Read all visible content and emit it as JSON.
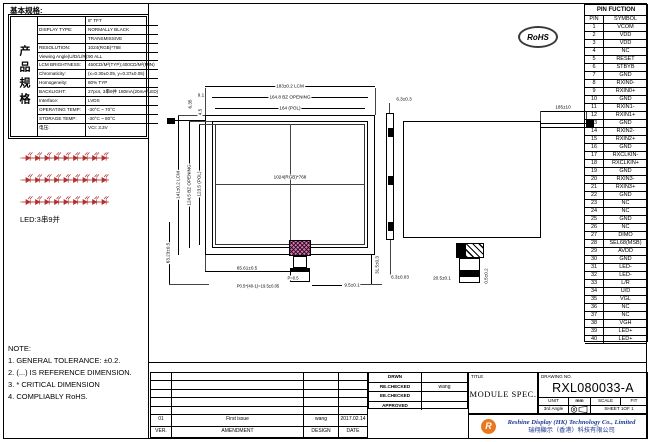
{
  "spec": {
    "header": "基本规格:",
    "side_label": "产品规格",
    "rows": [
      {
        "label": "",
        "value": "8\" TFT"
      },
      {
        "label": "DISPLAY TYPE:",
        "value": "NORMALLY BLACK"
      },
      {
        "label": "",
        "value": "TRANSMISSIVE"
      },
      {
        "label": "RESOLUTION:",
        "value": "1024(RGB)*768"
      },
      {
        "label": "Viewing Angle(U/D/L/R):",
        "value": "90  ALL"
      },
      {
        "label": "LCM BRIGHTNESS:",
        "value": "450CD/M²(TYP);400CD/M²(MIN)"
      },
      {
        "label": "Chromaticity:",
        "value": "(x=0.30±0.05, y=0.37±0.05)"
      },
      {
        "label": "Homogeneity:",
        "value": "80% TYP"
      },
      {
        "label": "BACKLIGHT:",
        "value": "27pcs, 3串9并 180mA(20mA/LED)"
      },
      {
        "label": "Interface:",
        "value": "LVDS"
      },
      {
        "label": "OPERATING TEMP:",
        "value": "-30°C ~ 70°C"
      },
      {
        "label": "STORAGE TEMP:",
        "value": "-30°C ~ 80°C"
      },
      {
        "label": "电压:",
        "value": "VCI: 3.3V"
      }
    ]
  },
  "led": {
    "label": "LED:3串9并"
  },
  "notes": {
    "title": "NOTE:",
    "items": [
      "1. GENERAL TOLERANCE: ±0.2.",
      "2. (...) IS REFERENCE DIMENSION.",
      "3. * CRITICAL DIMENSION",
      "4. COMPLIABLY RoHS."
    ]
  },
  "rohs": "RoHS",
  "front_view": {
    "dims": {
      "width_lcm": "183±0.2 LCM",
      "width_bz": "164.8  BZ OPENING",
      "width_pol": "164  (POL)",
      "offset_top": "9.1",
      "height_lcm": "141±0.2 LCM",
      "height_bz": "124.5 BZ OPENING",
      "height_pol": "123.5 (POL)",
      "offset_left_a": "6.35",
      "offset_left_b": "4.5",
      "resolution": "1024(RGB)*768",
      "fpc_x": "65.61±0.5",
      "fpc_y": "63.23±0.5",
      "fpc_drop": "31.5±0.3",
      "pitch": "P=0.5",
      "pitch_total": "P0.5*(40-1)=19.5±0.05",
      "end_margin": "9.5±0.1"
    }
  },
  "rear_view": {
    "dims": {
      "thickness_top": "6.3±0.3",
      "thickness_bottom": "6.3±0.03",
      "wire_length": "185±10",
      "fpc_width": "20.5±0.1",
      "fpc_side": "0.5±0.2"
    }
  },
  "pins": {
    "title": "PIN FUCTION",
    "col_pin": "PIN",
    "col_symbol": "SYMBOL",
    "rows": [
      {
        "pin": "1",
        "symbol": "VCOM"
      },
      {
        "pin": "2",
        "symbol": "VDD"
      },
      {
        "pin": "3",
        "symbol": "VDD"
      },
      {
        "pin": "4",
        "symbol": "NC"
      },
      {
        "pin": "5",
        "symbol": "RESET"
      },
      {
        "pin": "6",
        "symbol": "STBYB"
      },
      {
        "pin": "7",
        "symbol": "GND"
      },
      {
        "pin": "8",
        "symbol": "RXIN0-"
      },
      {
        "pin": "9",
        "symbol": "RXIN0+"
      },
      {
        "pin": "10",
        "symbol": "GND"
      },
      {
        "pin": "11",
        "symbol": "RXIN1-"
      },
      {
        "pin": "12",
        "symbol": "RXIN1+"
      },
      {
        "pin": "13",
        "symbol": "GND"
      },
      {
        "pin": "14",
        "symbol": "RXIN2-"
      },
      {
        "pin": "15",
        "symbol": "RXIN2+"
      },
      {
        "pin": "16",
        "symbol": "GND"
      },
      {
        "pin": "17",
        "symbol": "RXCLKIN-"
      },
      {
        "pin": "18",
        "symbol": "RXCLKIN+"
      },
      {
        "pin": "19",
        "symbol": "GND"
      },
      {
        "pin": "20",
        "symbol": "RXIN3-"
      },
      {
        "pin": "21",
        "symbol": "RXIN3+"
      },
      {
        "pin": "22",
        "symbol": "GND"
      },
      {
        "pin": "23",
        "symbol": "NC"
      },
      {
        "pin": "24",
        "symbol": "NC"
      },
      {
        "pin": "25",
        "symbol": "GND"
      },
      {
        "pin": "26",
        "symbol": "NC"
      },
      {
        "pin": "27",
        "symbol": "DIMO"
      },
      {
        "pin": "28",
        "symbol": "SEL68(MSB)"
      },
      {
        "pin": "29",
        "symbol": "AVDD"
      },
      {
        "pin": "30",
        "symbol": "GND"
      },
      {
        "pin": "31",
        "symbol": "LED-"
      },
      {
        "pin": "32",
        "symbol": "LED-"
      },
      {
        "pin": "33",
        "symbol": "L/R"
      },
      {
        "pin": "34",
        "symbol": "U/D"
      },
      {
        "pin": "35",
        "symbol": "VGL"
      },
      {
        "pin": "36",
        "symbol": "NC"
      },
      {
        "pin": "37",
        "symbol": "NC"
      },
      {
        "pin": "38",
        "symbol": "VGH"
      },
      {
        "pin": "39",
        "symbol": "LED+"
      },
      {
        "pin": "40",
        "symbol": "LED+"
      }
    ]
  },
  "revision": {
    "row": {
      "ver": "01",
      "amendment": "First issue",
      "design": "wang",
      "date": "2017.02.14"
    },
    "header": {
      "ver": "VER.",
      "amendment": "AMENDMENT",
      "design": "DESIGN",
      "date": "DATE"
    }
  },
  "approval": {
    "rows": [
      {
        "label": "DRWN",
        "value": ""
      },
      {
        "label": "RE.CHECKED",
        "value": "wang"
      },
      {
        "label": "EE.CHECKED",
        "value": ""
      },
      {
        "label": "APPROVED",
        "value": ""
      }
    ]
  },
  "title_block": {
    "title_label": "TITLE",
    "title": "MODULE SPEC.",
    "drawing_no_label": "DRAWING NO.",
    "drawing_no": "RXL080033-A",
    "unit_label": "UNIT",
    "unit_value": "mm",
    "scale_label": "SCALE",
    "scale_value": "FIT",
    "angle": "3rd Angle",
    "sheet": "SHEET 1OF 1",
    "company_en": "Reshine Display (HK) Technology Co., Limited",
    "company_cn": "瑞翔顯示（香港）科技有限公司",
    "logo_letter": "R"
  },
  "colors": {
    "company_blue": "#1f3a93",
    "logo_orange": "#e8791e",
    "led_red": "#b03030",
    "fpc_pink": "#e470b8"
  }
}
